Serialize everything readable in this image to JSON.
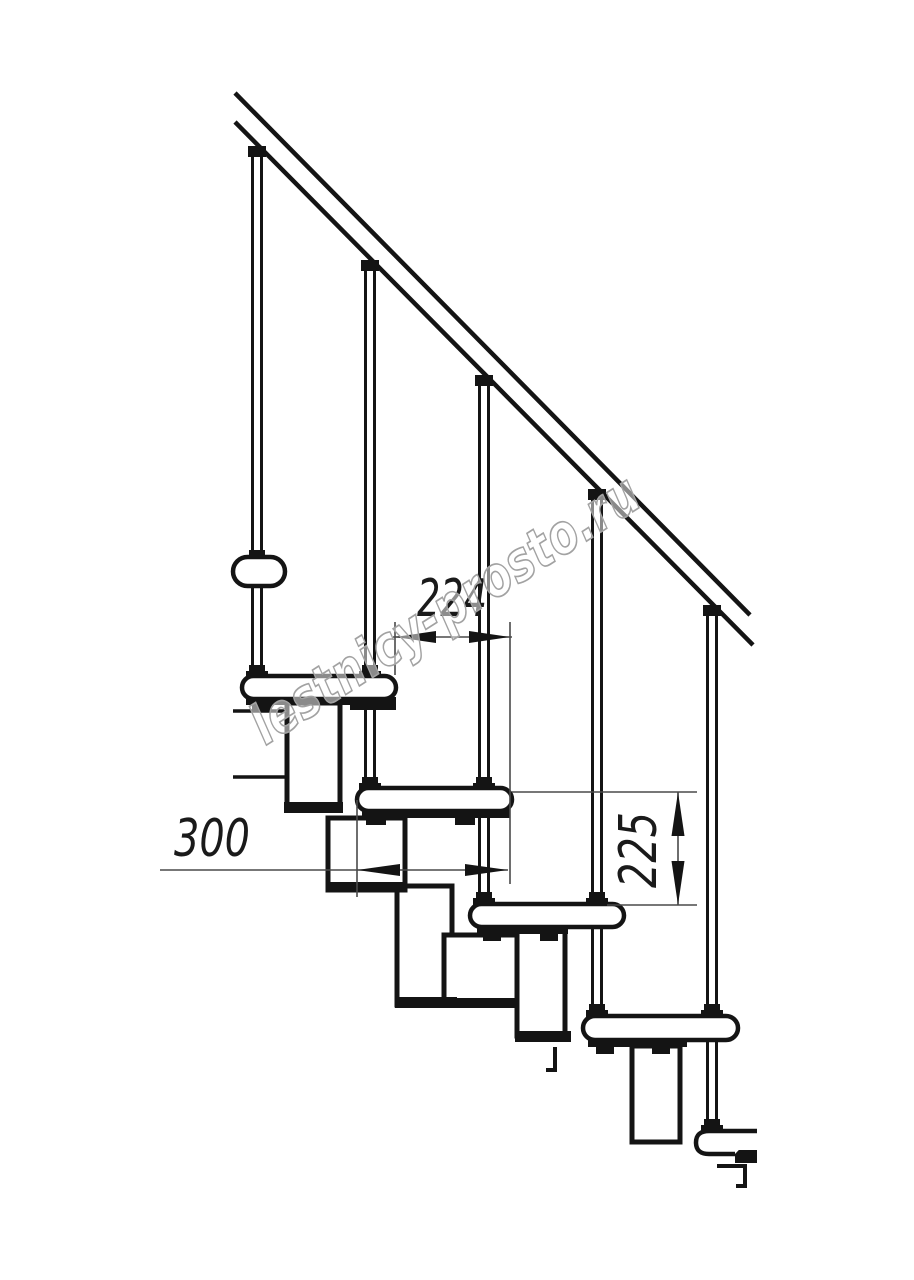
{
  "drawing": {
    "description": "Technical side-elevation drawing of a modular staircase with handrail, balusters, treads and central stringer modules",
    "background_color": "#ffffff",
    "line_color": "#141414",
    "dimension_line_color": "#4a4a4a",
    "dimensions": [
      {
        "id": "tread-offset-horizontal",
        "value": "224"
      },
      {
        "id": "tread-depth",
        "value": "300"
      },
      {
        "id": "riser-height",
        "value": "225"
      }
    ],
    "watermark": {
      "text": "lestnicy-prosto.ru",
      "stroke_color": "#a2a2a2",
      "fill_color": "#ffffff"
    }
  }
}
